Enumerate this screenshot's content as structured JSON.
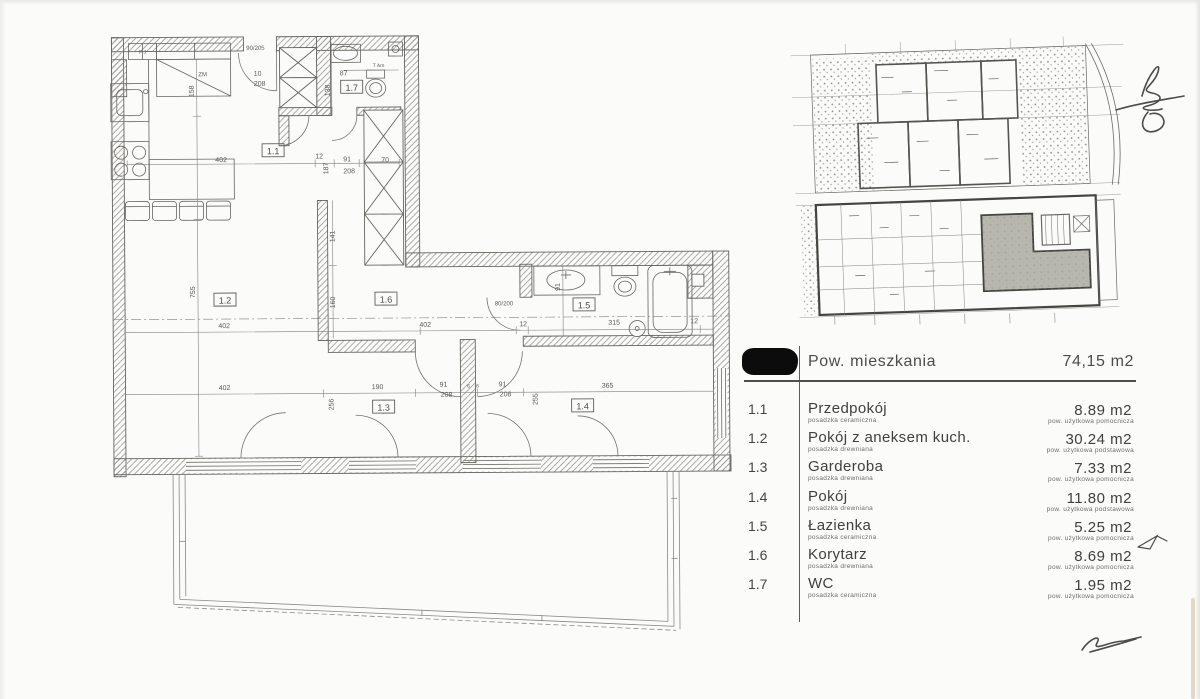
{
  "summary_table": {
    "header": {
      "label": "Pow. mieszkania",
      "value": "74,15 m2"
    },
    "rows": [
      {
        "no": "1.1",
        "name": "Przedpokój",
        "floor": "posadzka ceramiczna",
        "area": "8.89 m2",
        "area_type": "pow. użytkowa pomocnicza"
      },
      {
        "no": "1.2",
        "name": "Pokój z aneksem kuch.",
        "floor": "posadzka drewniana",
        "area": "30.24 m2",
        "area_type": "pow. użytkowa podstawowa"
      },
      {
        "no": "1.3",
        "name": "Garderoba",
        "floor": "posadzka drewniana",
        "area": "7.33 m2",
        "area_type": "pow. użytkowa pomocnicza"
      },
      {
        "no": "1.4",
        "name": "Pokój",
        "floor": "posadzka drewniana",
        "area": "11.80 m2",
        "area_type": "pow. użytkowa podstawowa"
      },
      {
        "no": "1.5",
        "name": "Łazienka",
        "floor": "posadzka ceramiczna",
        "area": "5.25 m2",
        "area_type": "pow. użytkowa pomocnicza"
      },
      {
        "no": "1.6",
        "name": "Korytarz",
        "floor": "posadzka drewniana",
        "area": "8.69 m2",
        "area_type": "pow. użytkowa pomocnicza"
      },
      {
        "no": "1.7",
        "name": "WC",
        "floor": "posadzka ceramiczna",
        "area": "1.95 m2",
        "area_type": "pow. użytkowa pomocnicza"
      }
    ]
  },
  "floor_plan": {
    "room_labels": [
      {
        "t": "1.1",
        "x": 274,
        "y": 152
      },
      {
        "t": "1.2",
        "x": 225,
        "y": 301
      },
      {
        "t": "1.3",
        "x": 383,
        "y": 409
      },
      {
        "t": "1.4",
        "x": 582,
        "y": 409
      },
      {
        "t": "1.5",
        "x": 584,
        "y": 308
      },
      {
        "t": "1.6",
        "x": 386,
        "y": 301
      },
      {
        "t": "1.7",
        "x": 353,
        "y": 89
      }
    ],
    "dimensions": [
      {
        "t": "402",
        "x": 222,
        "y": 161
      },
      {
        "t": "402",
        "x": 224,
        "y": 327
      },
      {
        "t": "402",
        "x": 425,
        "y": 327
      },
      {
        "t": "402",
        "x": 224,
        "y": 389
      },
      {
        "t": "315",
        "x": 614,
        "y": 326
      },
      {
        "t": "365",
        "x": 607,
        "y": 389
      },
      {
        "t": "190",
        "x": 377,
        "y": 389
      },
      {
        "t": "87",
        "x": 345,
        "y": 75
      },
      {
        "t": "12",
        "x": 320,
        "y": 158
      },
      {
        "t": "70",
        "x": 386,
        "y": 162
      },
      {
        "t": "12",
        "x": 523,
        "y": 327
      },
      {
        "t": "12",
        "x": 694,
        "y": 325
      },
      {
        "t": "91",
        "x": 443,
        "y": 387
      },
      {
        "t": "208",
        "x": 446,
        "y": 397
      },
      {
        "t": "91",
        "x": 502,
        "y": 387
      },
      {
        "t": "208",
        "x": 505,
        "y": 397
      },
      {
        "t": "91",
        "x": 348,
        "y": 161
      },
      {
        "t": "208",
        "x": 350,
        "y": 173
      },
      {
        "t": "10",
        "x": 259,
        "y": 75
      },
      {
        "t": "208",
        "x": 261,
        "y": 85
      },
      {
        "t": "90/205",
        "x": 257,
        "y": 49,
        "s": 6
      },
      {
        "t": "80/200",
        "x": 504,
        "y": 306,
        "s": 6
      },
      {
        "t": "6",
        "x": 468,
        "y": 388,
        "s": 5
      },
      {
        "t": "6",
        "x": 477,
        "y": 388,
        "s": 5
      },
      {
        "t": "158",
        "x": 195,
        "y": 90,
        "r": 1
      },
      {
        "t": "755",
        "x": 195,
        "y": 291,
        "r": 1
      },
      {
        "t": "138",
        "x": 331,
        "y": 90,
        "r": 1
      },
      {
        "t": "187",
        "x": 329,
        "y": 168,
        "r": 1
      },
      {
        "t": "141",
        "x": 335,
        "y": 236,
        "r": 1
      },
      {
        "t": "160",
        "x": 335,
        "y": 302,
        "r": 1
      },
      {
        "t": "256",
        "x": 333,
        "y": 404,
        "r": 1
      },
      {
        "t": "255",
        "x": 537,
        "y": 400,
        "r": 1
      },
      {
        "t": "91",
        "x": 560,
        "y": 288,
        "r": 1
      },
      {
        "t": "ZM",
        "x": 204,
        "y": 75,
        "s": 6
      },
      {
        "t": "F J",
        "x": 144,
        "y": 52,
        "s": 5
      },
      {
        "t": "T Am",
        "x": 380,
        "y": 67,
        "s": 5
      }
    ]
  },
  "site_plan": {
    "highlight_color": "#b7b7b0"
  }
}
